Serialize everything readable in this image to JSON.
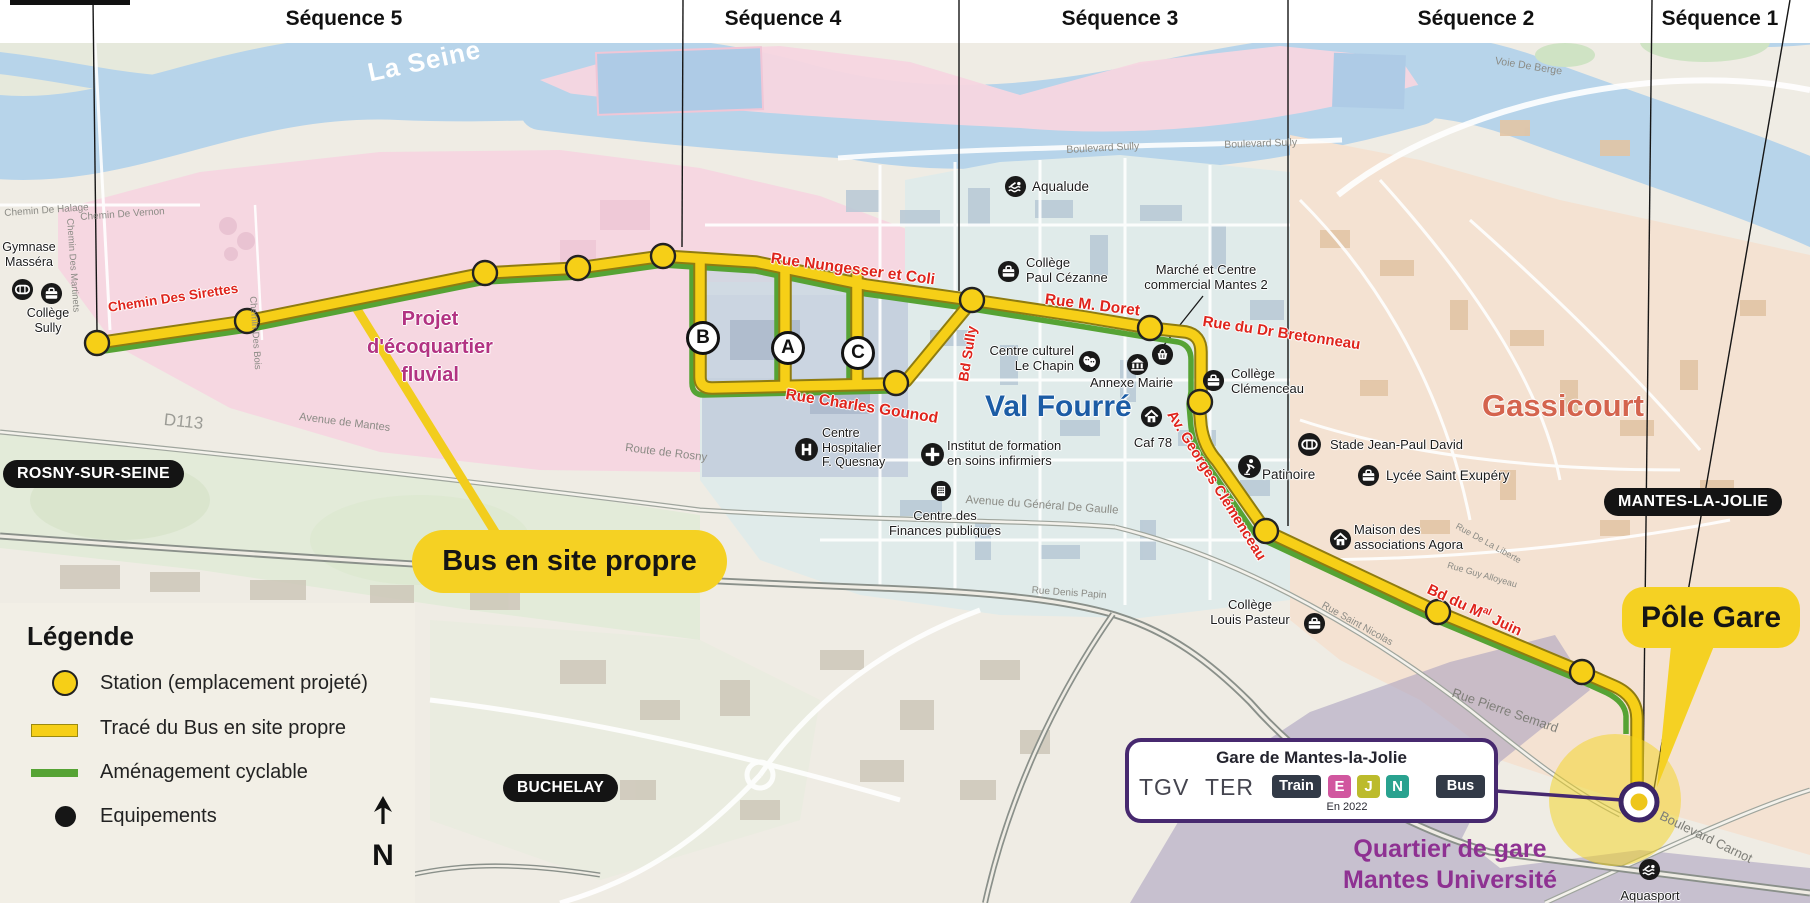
{
  "title_band": {
    "sequences": [
      "Séquence 5",
      "Séquence 4",
      "Séquence 3",
      "Séquence 2",
      "Séquence 1"
    ]
  },
  "colors": {
    "route_yellow": "#f6cf17",
    "cycle_green": "#56a334",
    "street_red": "#df241c",
    "purple_gare": "#47296f",
    "badge_e": "#d1579f",
    "badge_j": "#bcbb2c",
    "badge_n": "#29a28f",
    "badge_dark": "#323a47"
  },
  "map": {
    "river": "La Seine",
    "districts": {
      "ecoquartier": [
        "Projet",
        "d'écoquartier",
        "fluvial"
      ],
      "val_fourre": "Val Fourré",
      "gassicourt": "Gassicourt",
      "quartier_gare": [
        "Quartier de gare",
        "Mantes Université"
      ]
    },
    "cities": {
      "rosny": "ROSNY-SUR-SEINE",
      "buchelay": "BUCHELAY",
      "mantes": "MANTES-LA-JOLIE"
    },
    "streets_red": {
      "sirettes": "Chemin Des Sirettes",
      "nungesser": "Rue Nungesser et Coli",
      "doret": "Rue M. Doret",
      "bretonneau": "Rue du Dr Bretonneau",
      "gounod": "Rue Charles Gounod",
      "bd_sully": "Bd Sully",
      "clemenceau": "Av. Georges Clémenceau",
      "mal_juin": {
        "p1": "Bd du M",
        "sup": "al",
        "p2": " Juin"
      }
    },
    "streets_gray": {
      "halage": "Chemin De Halage",
      "vernon": "Chemin De Vernon",
      "martinets": "Chemin Des Martinets",
      "bois": "Chemin Des Bois",
      "d113": "D113",
      "av_mantes": "Avenue de Mantes",
      "route_rosny": "Route de Rosny",
      "bd_sully_1": "Boulevard Sully",
      "bd_sully_2": "Boulevard Sully",
      "voie_berge": "Voie De Berge",
      "de_gaulle": "Avenue du Général De Gaulle",
      "denis_papin": "Rue Denis Papin",
      "saint_nicolas": "Rue Saint Nicolas",
      "pierre_semard": "Rue Pierre Semard",
      "carnot": "Boulevard Carnot",
      "liberte": "Rue De La Liberte",
      "alloyeau": "Rue Guy Alloyeau"
    },
    "pois": {
      "gymnase": [
        "Gymnase",
        "Masséra"
      ],
      "sully": [
        "Collège",
        "Sully"
      ],
      "aqualude": "Aqualude",
      "cezanne": [
        "Collège",
        "Paul Cézanne"
      ],
      "marche": [
        "Marché et Centre",
        "commercial Mantes 2"
      ],
      "chapin": [
        "Centre culturel",
        "Le Chapin"
      ],
      "mairie": "Annexe Mairie",
      "clemenceau_college": [
        "Collège",
        "Clémenceau"
      ],
      "caf": "Caf 78",
      "hopital": [
        "Centre",
        "Hospitalier",
        "F. Quesnay"
      ],
      "institut": [
        "Institut de formation",
        "en soins infirmiers"
      ],
      "finances": [
        "Centre des",
        "Finances publiques"
      ],
      "stade": "Stade Jean-Paul David",
      "patinoire": "Patinoire",
      "lycee": "Lycée Saint Exupéry",
      "agora": [
        "Maison des",
        "associations Agora"
      ],
      "pasteur": [
        "Collège",
        "Louis Pasteur"
      ],
      "aquasport": "Aquasport"
    },
    "stop_letters": [
      "B",
      "A",
      "C"
    ]
  },
  "callouts": {
    "bus": "Bus en site propre",
    "pole_gare": "Pôle Gare"
  },
  "gare_box": {
    "title": "Gare de Mantes-la-Jolie",
    "tgv": "TGV",
    "ter": "TER",
    "train_badge": "Train",
    "rer_e": "E",
    "line_j": "J",
    "line_n": "N",
    "bus_badge": "Bus",
    "note": "En 2022"
  },
  "legend": {
    "title": "Légende",
    "station": "Station (emplacement projeté)",
    "trace": "Tracé du Bus en site propre",
    "cyclable": "Aménagement cyclable",
    "equipements": "Equipements"
  },
  "compass": "N"
}
